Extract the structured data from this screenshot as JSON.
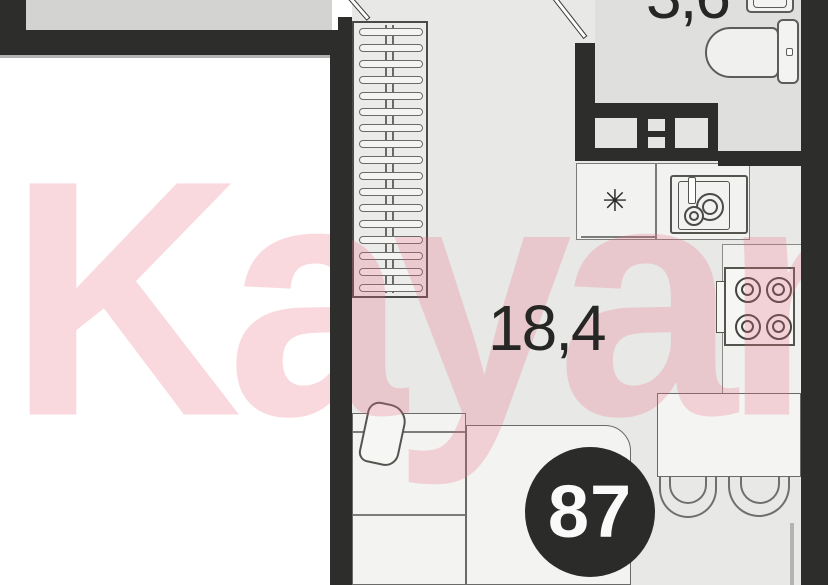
{
  "watermark": {
    "text": "Kayan"
  },
  "unit": {
    "number": "87"
  },
  "rooms": [
    {
      "id": "living-room",
      "area_label": "18,4"
    },
    {
      "id": "bathroom",
      "area_label": "3,6"
    }
  ],
  "icons": {
    "fridge_snowflake": "✳"
  },
  "colors": {
    "wall": "#2d2d2b",
    "floor": "#e8e8e7",
    "floor_bathroom": "#dfdfde",
    "floor_neighbor": "#d3d3d2",
    "furniture_outline": "#5c5c5a",
    "watermark_pink": "#e76c7e",
    "badge_background": "#2b2b29",
    "badge_text": "#fafafa"
  }
}
